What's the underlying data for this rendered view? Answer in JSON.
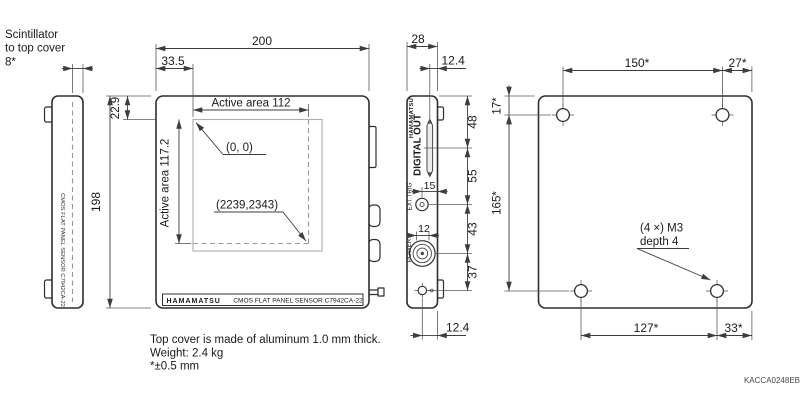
{
  "colors": {
    "accent_red": "#d2001e",
    "line": "#2e2e2e",
    "dim": "#3d3d3d",
    "gray_dash": "#979797"
  },
  "annotation": {
    "scintillator_line1": "Scintillator",
    "scintillator_line2": "to top cover",
    "scintillator_line3": "8*"
  },
  "left_view": {
    "panel_text": "CMOS FLAT PANEL SENSOR C7942CA-22",
    "height": "198"
  },
  "front_view": {
    "width": "200",
    "offset_left": "33.5",
    "offset_top": "22.9",
    "active_width": "Active area 112",
    "active_height": "Active area 117.2",
    "origin": "(0, 0)",
    "far_corner": "(2239,2343)",
    "brand": "HAMAMATSU",
    "model": "CMOS FLAT PANEL SENSOR C7942CA-22"
  },
  "side_view": {
    "width": "28",
    "top_offset": "12.4",
    "bottom_offset": "12.4",
    "brand": "HAMAMATSU",
    "connector_digital": "DIGITAL OUT",
    "connector_trig": "EXT.TRIG",
    "connector_power": "POWER",
    "trig_offset": "15",
    "power_dia": "12",
    "spacing": [
      "48",
      "55",
      "43",
      "37"
    ]
  },
  "back_view": {
    "hole_span_top": "150*",
    "hole_edge_top": "27*",
    "hole_top_offset": "17*",
    "hole_span_vertical": "165*",
    "hole_span_bottom": "127*",
    "hole_edge_bottom": "33*",
    "hole_note_line1": "(4 ×) M3",
    "hole_note_line2": "depth 4"
  },
  "notes": {
    "line1": "Top cover is made of aluminum 1.0 mm thick.",
    "line2": "Weight: 2.4 kg",
    "line3": "*±0.5 mm"
  },
  "doc_number": "KACCA0248EB"
}
